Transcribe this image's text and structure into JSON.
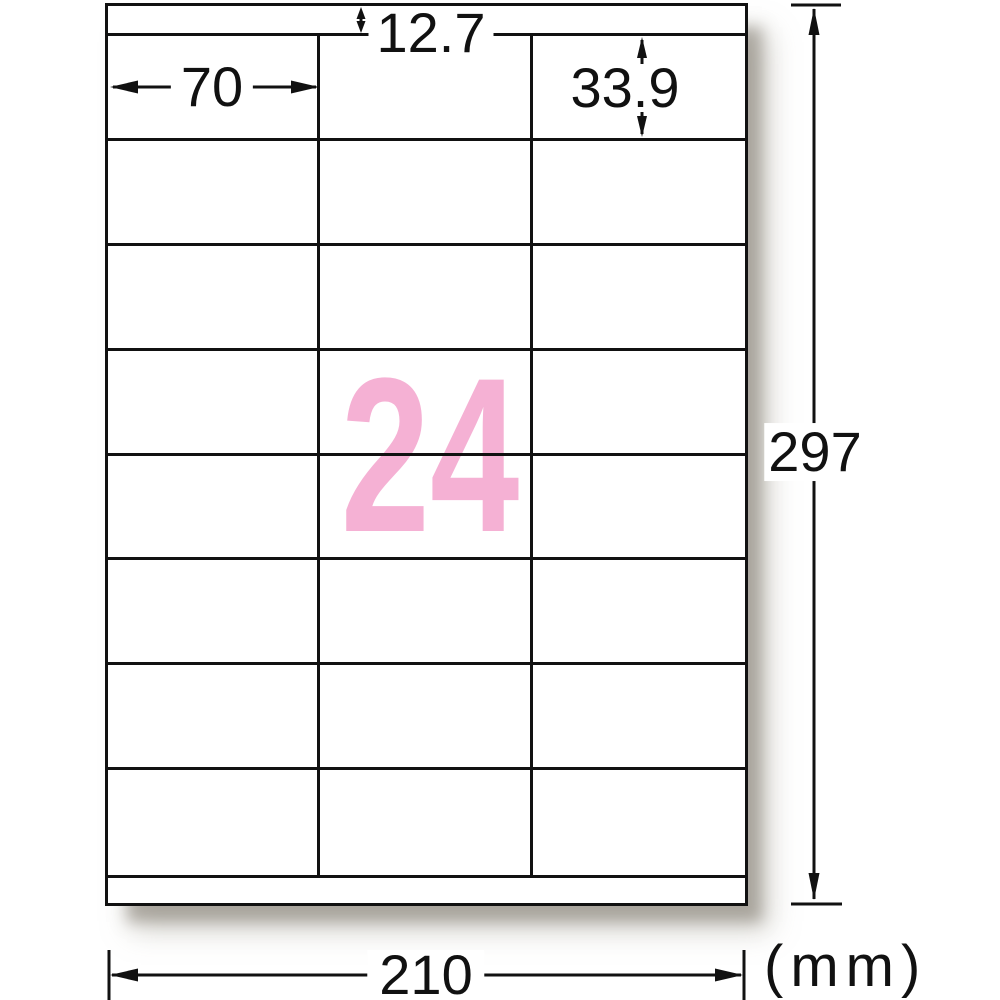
{
  "sheet": {
    "label_count": "24",
    "rows": 8,
    "columns": 3
  },
  "dimensions": {
    "top_margin_mm": "12.7",
    "label_width_mm": "70",
    "label_height_mm": "33.9",
    "page_width_mm": "210",
    "page_height_mm": "297",
    "unit_label": "(mm)"
  },
  "colors": {
    "count_accent": "#f5b1d4",
    "line": "#111111"
  }
}
